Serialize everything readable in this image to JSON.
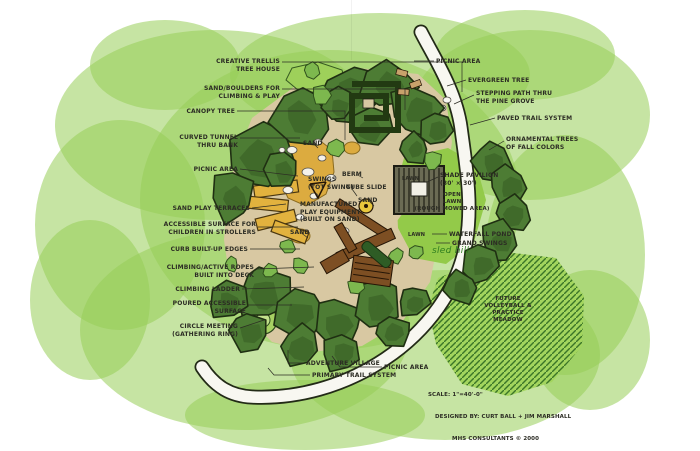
{
  "palette": {
    "background_green": "#98cd57",
    "tree_green": "#4d7c34",
    "tree_outline": "#1f2f12",
    "shrub_green": "#7db84e",
    "lawn_green": "#93ca49",
    "meadow_green": "#a3d55e",
    "hatch_green": "#2f6b22",
    "ground_tan": "#d8c8a2",
    "sand_yellow": "#dcab3f",
    "terrace_yellow": "#e2b23e",
    "timber_brown": "#7d4f23",
    "trail_white": "#f8f7f1",
    "ink": "#2c2c24",
    "hand_green": "#2e7d1f"
  },
  "title_block": {
    "scale": "SCALE: 1\"=40'-0\"",
    "designed_by": "DESIGNED BY: CURT BALL + JIM MARSHALL",
    "firm": "MHS CONSULTANTS © 2000"
  },
  "labels": [
    {
      "text": "CREATIVE TRELLIS\nTREE HOUSE",
      "x": 280,
      "y": 58,
      "align": "right",
      "leader": [
        [
          282,
          62
        ],
        [
          462,
          62
        ],
        [
          462,
          92
        ]
      ]
    },
    {
      "text": "SAND/BOULDERS FOR\nCLIMBING & PLAY",
      "x": 280,
      "y": 85,
      "align": "right",
      "leader": [
        [
          282,
          89
        ],
        [
          405,
          89
        ],
        [
          405,
          110
        ]
      ]
    },
    {
      "text": "CANOPY TREE",
      "x": 235,
      "y": 108,
      "align": "right",
      "leader": [
        [
          237,
          111
        ],
        [
          345,
          111
        ],
        [
          345,
          140
        ]
      ]
    },
    {
      "text": "CURVED TUNNEL\nTHRU BANK",
      "x": 238,
      "y": 134,
      "align": "right",
      "leader": [
        [
          240,
          138
        ],
        [
          300,
          138
        ]
      ]
    },
    {
      "text": "PICNIC AREA",
      "x": 238,
      "y": 166,
      "align": "right",
      "leader": [
        [
          240,
          169
        ],
        [
          298,
          176
        ]
      ]
    },
    {
      "text": "SAND PLAY TERRACES",
      "x": 250,
      "y": 205,
      "align": "right",
      "leader": [
        [
          252,
          208
        ],
        [
          286,
          204
        ]
      ]
    },
    {
      "text": "ACCESSIBLE SURFACE FOR\nCHILDREN IN STROLLERS",
      "x": 256,
      "y": 221,
      "align": "right",
      "leader": [
        [
          258,
          227
        ],
        [
          298,
          227
        ]
      ]
    },
    {
      "text": "CURB BUILT-UP EDGES",
      "x": 248,
      "y": 246,
      "align": "right",
      "leader": [
        [
          250,
          249
        ],
        [
          300,
          249
        ]
      ]
    },
    {
      "text": "CLIMBING/ACTIVE ROPES\nBUILT INTO DECK",
      "x": 254,
      "y": 264,
      "align": "right",
      "leader": [
        [
          256,
          269
        ],
        [
          314,
          267
        ]
      ]
    },
    {
      "text": "CLIMBING LADDER",
      "x": 240,
      "y": 286,
      "align": "right",
      "leader": [
        [
          242,
          289
        ],
        [
          304,
          287
        ]
      ]
    },
    {
      "text": "POURED ACCESSIBLE\nSURFACE",
      "x": 246,
      "y": 300,
      "align": "right",
      "leader": [
        [
          248,
          305
        ],
        [
          292,
          305
        ]
      ]
    },
    {
      "text": "CIRCLE MEETING\n(GATHERING RING)",
      "x": 238,
      "y": 323,
      "align": "right",
      "leader": [
        [
          240,
          328
        ],
        [
          264,
          320
        ]
      ]
    },
    {
      "text": "ADVENTURE VILLAGE",
      "x": 306,
      "y": 360,
      "align": "left",
      "leader": [
        [
          304,
          363
        ],
        [
          288,
          363
        ],
        [
          288,
          350
        ]
      ]
    },
    {
      "text": "PRIMARY TRAIL SYSTEM",
      "x": 312,
      "y": 372,
      "align": "left",
      "leader": [
        [
          310,
          375
        ],
        [
          274,
          375
        ],
        [
          268,
          368
        ]
      ]
    },
    {
      "text": "PICNIC AREA",
      "x": 384,
      "y": 364,
      "align": "left",
      "leader": [
        [
          382,
          367
        ],
        [
          340,
          367
        ],
        [
          332,
          356
        ]
      ]
    },
    {
      "text": "PICNIC AREA",
      "x": 436,
      "y": 58,
      "align": "left",
      "leader": [
        [
          434,
          61
        ],
        [
          414,
          61
        ]
      ]
    },
    {
      "text": "EVERGREEN TREE",
      "x": 468,
      "y": 77,
      "align": "left",
      "leader": [
        [
          466,
          80
        ],
        [
          447,
          86
        ]
      ]
    },
    {
      "text": "STEPPING PATH THRU\nTHE PINE GROVE",
      "x": 476,
      "y": 90,
      "align": "left",
      "leader": [
        [
          474,
          95
        ],
        [
          454,
          104
        ]
      ]
    },
    {
      "text": "PAVED TRAIL SYSTEM",
      "x": 497,
      "y": 115,
      "align": "left",
      "leader": [
        [
          495,
          118
        ],
        [
          470,
          125
        ]
      ]
    },
    {
      "text": "ORNAMENTAL TREES\nOF FALL COLORS",
      "x": 506,
      "y": 136,
      "align": "left",
      "leader": [
        [
          504,
          141
        ],
        [
          489,
          150
        ]
      ]
    },
    {
      "text": "SHADE PAVILION\n(30' × 30')",
      "x": 440,
      "y": 172,
      "align": "left",
      "leader": [
        [
          438,
          177
        ],
        [
          427,
          182
        ]
      ]
    },
    {
      "text": "OPEN\nLAWN\n(ROUGH MOWED AREA)",
      "x": 452,
      "y": 192,
      "align": "center",
      "size": 5.5
    },
    {
      "text": "LAWN",
      "x": 402,
      "y": 176,
      "align": "left",
      "size": 5
    },
    {
      "text": "LAWN",
      "x": 408,
      "y": 232,
      "align": "left",
      "size": 5
    },
    {
      "text": "WATERFALL POND",
      "x": 449,
      "y": 231,
      "align": "left",
      "leader": [
        [
          447,
          234
        ],
        [
          432,
          234
        ]
      ]
    },
    {
      "text": "GRAND SWINGS",
      "x": 452,
      "y": 240,
      "align": "left",
      "leader": [
        [
          450,
          243
        ],
        [
          436,
          243
        ]
      ]
    },
    {
      "text": "sled hill",
      "x": 432,
      "y": 246,
      "align": "left",
      "size": 9,
      "cls": "hand"
    },
    {
      "text": "FUTURE\nVOLLEYBALL &\nPRACTICE\nMEADOW",
      "x": 508,
      "y": 296,
      "align": "center",
      "size": 5.5
    },
    {
      "text": "BERM",
      "x": 342,
      "y": 171,
      "align": "left",
      "leader": [
        [
          356,
          174
        ],
        [
          363,
          178
        ]
      ]
    },
    {
      "text": "SWINGS\n(TOT SWING)",
      "x": 308,
      "y": 176,
      "align": "left"
    },
    {
      "text": "TUBE SLIDE",
      "x": 346,
      "y": 184,
      "align": "left",
      "leader": [
        [
          352,
          189
        ],
        [
          357,
          196
        ]
      ]
    },
    {
      "text": "SAND",
      "x": 358,
      "y": 197,
      "align": "left",
      "leader": [
        [
          368,
          200
        ],
        [
          374,
          206
        ]
      ]
    },
    {
      "text": "SAND",
      "x": 290,
      "y": 229,
      "align": "left",
      "leader": [
        [
          300,
          232
        ],
        [
          308,
          238
        ]
      ]
    },
    {
      "text": "SAND",
      "x": 303,
      "y": 140,
      "align": "left",
      "leader": [
        [
          313,
          143
        ],
        [
          318,
          148
        ]
      ]
    },
    {
      "text": "MANUFACTURED\nPLAY EQUIPMENT\n(BUILT ON SAND)",
      "x": 300,
      "y": 201,
      "align": "left"
    }
  ]
}
